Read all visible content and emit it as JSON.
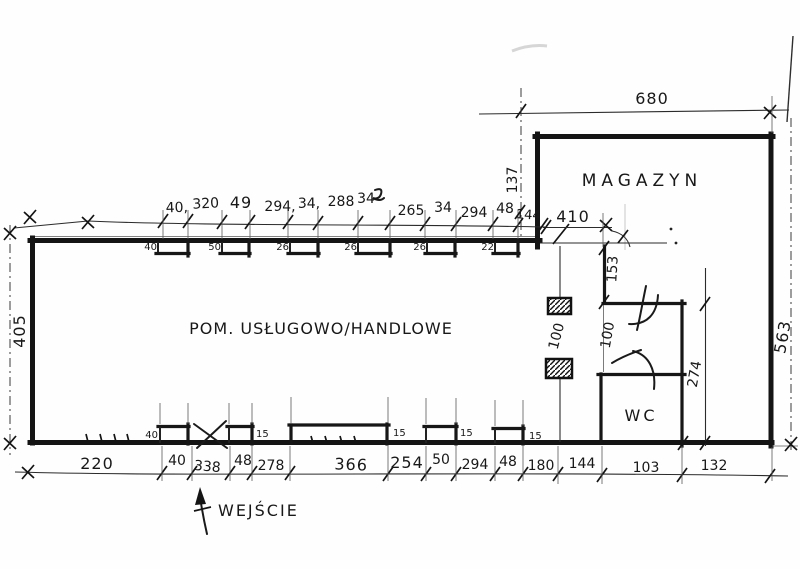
{
  "plan": {
    "rooms": {
      "main": "POM. USŁUGOWO/HANDLOWE",
      "storage": "MAGAZYN",
      "wc": "WC"
    },
    "entrance": "WEJŚCIE",
    "dims": {
      "top": [
        "40,",
        "320",
        "49",
        "294,",
        "34,",
        "288",
        "34",
        "265",
        "34",
        "294",
        "48",
        "144"
      ],
      "top_right_width": "410",
      "storage_width": "680",
      "storage_offset": "137",
      "left_height": "405",
      "right_height": "563",
      "inner_top": "153",
      "inner_mid_left": "100",
      "inner_mid_right": "100",
      "wc_height": "274",
      "bottom": [
        "220",
        "40",
        "338",
        "48",
        "278",
        "366",
        "254",
        "50",
        "294",
        "48",
        "180",
        "144",
        "103",
        "132"
      ],
      "top_recess": [
        "40",
        "50",
        "26",
        "26",
        "26",
        "22"
      ],
      "bottom_recess": [
        "40",
        "15",
        "15",
        "15",
        "15"
      ]
    }
  }
}
